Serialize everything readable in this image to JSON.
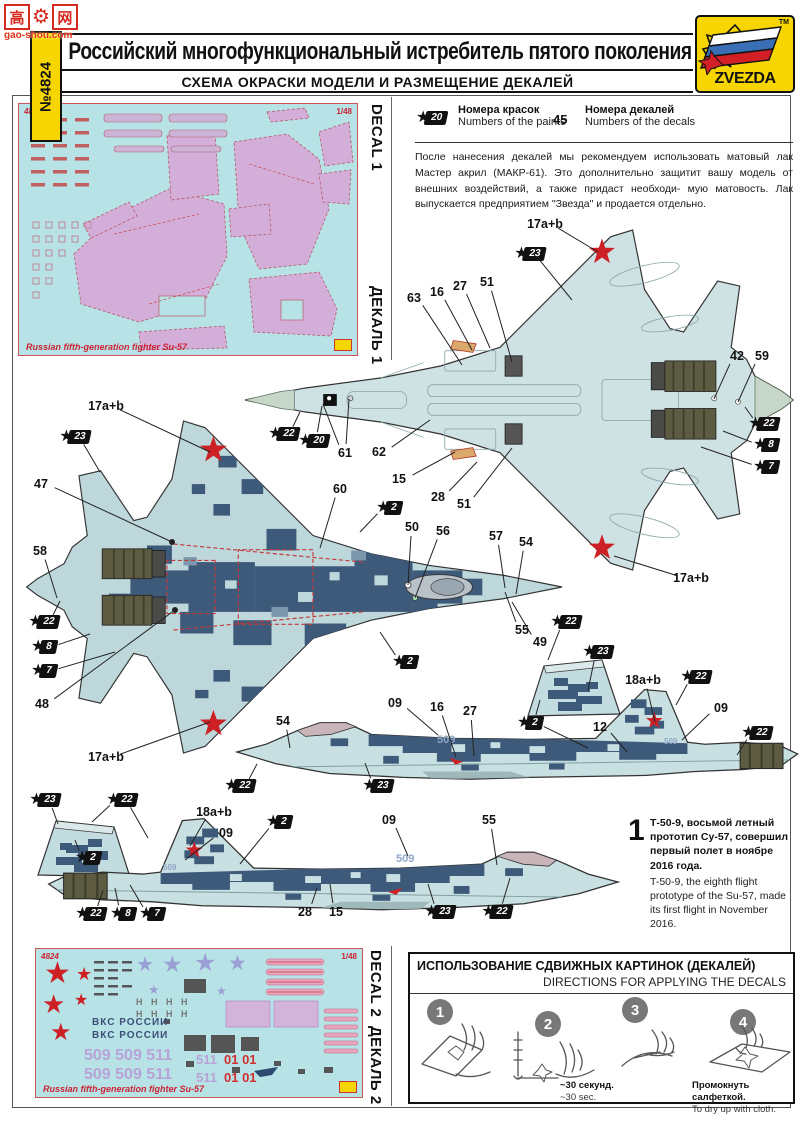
{
  "watermark": {
    "char1": "高",
    "char2": "网",
    "domain": "gao-shou.com"
  },
  "header": {
    "kit_number": "№4824",
    "title": "Российский многофункциональный истребитель пятого поколения Су-57",
    "subtitle": "СХЕМА ОКРАСКИ МОДЕЛИ И РАЗМЕЩЕНИЕ ДЕКАЛЕЙ",
    "brand": "ZVEZDA",
    "brand_tm": "TM"
  },
  "legend": {
    "paint_badge": "20",
    "paint_label_ru": "Номера красок",
    "paint_label_en": "Numbers of the paints",
    "decal_number": "45",
    "decal_label_ru": "Номера декалей",
    "decal_label_en": "Numbers of the decals",
    "note": "После нанесения декалей мы рекомендуем использовать матовый лак Мастер акрил (МАКР-61). Это дополнительно защитит вашу модель от внешних воздействий, а также придаст необходи- мую матовость. Лак выпускается предприятием \"Звезда\" и продается отдельно."
  },
  "decal_sheet_1": {
    "code": "4824",
    "scale": "1/48",
    "caption": "Russian fifth-generation fighter Su-57",
    "side_label_en": "DECAL 1",
    "side_label_ru": "ДЕКАЛЬ 1"
  },
  "decal_sheet_2": {
    "code": "4824",
    "scale": "1/48",
    "caption": "Russian fifth-generation fighter Su-57",
    "side_label_en": "DECAL 2",
    "side_label_ru": "ДЕКАЛЬ 2",
    "vks_text": "ВКС РОССИИ",
    "numbers_row": "509 509 511",
    "numbers_511": "511",
    "numbers_01": "01 01"
  },
  "aircraft": {
    "tail_number": "509"
  },
  "note_block": {
    "index": "1",
    "ru": "Т-50-9, восьмой летный прототип Су-57, совершил первый полет в ноябре 2016 года.",
    "en": "T-50-9, the eighth flight prototype of the Su-57, made its first flight in November 2016."
  },
  "directions": {
    "title_ru": "ИСПОЛЬЗОВАНИЕ СДВИЖНЫХ КАРТИНОК (ДЕКАЛЕЙ)",
    "title_en": "DIRECTIONS  FOR APPLYING THE DECALS",
    "step1": "1",
    "step2": "2",
    "step3": "3",
    "step4": "4",
    "cap2_ru": "~30 секунд.",
    "cap2_en": "~30 sec.",
    "cap4_ru": "Промокнуть салфеткой.",
    "cap4_en": "To dry up with cloth."
  },
  "colors": {
    "brand_yellow": "#f6d500",
    "decal_sheet_bg": "#b7e2e6",
    "decal_pink": "#d2aed8",
    "airframe_light": "#cfe2e3",
    "camo_dark": "#3e5a7a",
    "star_red": "#cc2025"
  },
  "callouts": [
    {
      "t": "plain",
      "v": "17a+b",
      "x": 545,
      "y": 224,
      "l": [
        [
          598,
          252
        ]
      ]
    },
    {
      "t": "badge",
      "v": "23",
      "x": 530,
      "y": 254,
      "l": [
        [
          572,
          300
        ]
      ]
    },
    {
      "t": "plain",
      "v": "63",
      "x": 414,
      "y": 298,
      "l": [
        [
          462,
          365
        ]
      ]
    },
    {
      "t": "plain",
      "v": "16",
      "x": 437,
      "y": 292,
      "l": [
        [
          472,
          350
        ]
      ]
    },
    {
      "t": "plain",
      "v": "27",
      "x": 460,
      "y": 286,
      "l": [
        [
          490,
          348
        ]
      ]
    },
    {
      "t": "plain",
      "v": "51",
      "x": 487,
      "y": 282,
      "l": [
        [
          512,
          362
        ]
      ]
    },
    {
      "t": "plain",
      "v": "42",
      "x": 737,
      "y": 356,
      "l": [
        [
          714,
          399
        ]
      ]
    },
    {
      "t": "plain",
      "v": "59",
      "x": 762,
      "y": 356,
      "l": [
        [
          738,
          402
        ]
      ]
    },
    {
      "t": "badge",
      "v": "22",
      "x": 764,
      "y": 424,
      "l": [
        [
          745,
          407
        ]
      ]
    },
    {
      "t": "badge",
      "v": "8",
      "x": 766,
      "y": 445,
      "l": [
        [
          723,
          431
        ]
      ]
    },
    {
      "t": "badge",
      "v": "7",
      "x": 766,
      "y": 467,
      "l": [
        [
          701,
          447
        ]
      ]
    },
    {
      "t": "badge",
      "v": "22",
      "x": 284,
      "y": 434,
      "l": [
        [
          300,
          412
        ]
      ]
    },
    {
      "t": "badge",
      "v": "20",
      "x": 314,
      "y": 441,
      "l": [
        [
          322,
          406
        ]
      ]
    },
    {
      "t": "plain",
      "v": "61",
      "x": 345,
      "y": 453,
      "l": [
        [
          323,
          404
        ],
        [
          349,
          399
        ]
      ]
    },
    {
      "t": "plain",
      "v": "62",
      "x": 379,
      "y": 452,
      "l": [
        [
          430,
          420
        ]
      ]
    },
    {
      "t": "plain",
      "v": "15",
      "x": 399,
      "y": 479,
      "l": [
        [
          455,
          452
        ]
      ]
    },
    {
      "t": "plain",
      "v": "28",
      "x": 438,
      "y": 497,
      "l": [
        [
          477,
          462
        ]
      ]
    },
    {
      "t": "plain",
      "v": "51",
      "x": 464,
      "y": 504,
      "l": [
        [
          512,
          448
        ]
      ]
    },
    {
      "t": "plain",
      "v": "17a+b",
      "x": 691,
      "y": 578,
      "l": [
        [
          614,
          556
        ]
      ]
    },
    {
      "t": "plain",
      "v": "17a+b",
      "x": 106,
      "y": 406,
      "l": [
        [
          210,
          452
        ]
      ]
    },
    {
      "t": "badge",
      "v": "23",
      "x": 75,
      "y": 437,
      "l": [
        [
          100,
          472
        ]
      ]
    },
    {
      "t": "plain",
      "v": "47",
      "x": 41,
      "y": 484,
      "l": [
        [
          172,
          542
        ]
      ]
    },
    {
      "t": "plain",
      "v": "58",
      "x": 40,
      "y": 551,
      "l": [
        [
          57,
          598
        ]
      ]
    },
    {
      "t": "badge",
      "v": "22",
      "x": 44,
      "y": 622,
      "l": [
        [
          60,
          601
        ]
      ]
    },
    {
      "t": "badge",
      "v": "8",
      "x": 44,
      "y": 647,
      "l": [
        [
          90,
          634
        ]
      ]
    },
    {
      "t": "badge",
      "v": "7",
      "x": 44,
      "y": 671,
      "l": [
        [
          115,
          652
        ]
      ]
    },
    {
      "t": "plain",
      "v": "48",
      "x": 42,
      "y": 704,
      "l": [
        [
          175,
          610
        ]
      ]
    },
    {
      "t": "plain",
      "v": "60",
      "x": 340,
      "y": 489,
      "l": [
        [
          320,
          548
        ]
      ]
    },
    {
      "t": "badge",
      "v": "2",
      "x": 389,
      "y": 508,
      "l": [
        [
          360,
          532
        ]
      ]
    },
    {
      "t": "plain",
      "v": "50",
      "x": 412,
      "y": 527,
      "l": [
        [
          408,
          585
        ]
      ]
    },
    {
      "t": "plain",
      "v": "56",
      "x": 443,
      "y": 531,
      "l": [
        [
          415,
          598
        ]
      ]
    },
    {
      "t": "plain",
      "v": "57",
      "x": 496,
      "y": 536,
      "l": [
        [
          505,
          588
        ]
      ]
    },
    {
      "t": "plain",
      "v": "54",
      "x": 526,
      "y": 542,
      "l": [
        [
          516,
          594
        ]
      ]
    },
    {
      "t": "plain",
      "v": "49",
      "x": 540,
      "y": 642,
      "l": [
        [
          512,
          602
        ]
      ]
    },
    {
      "t": "plain",
      "v": "55",
      "x": 522,
      "y": 630,
      "l": [
        [
          505,
          592
        ]
      ]
    },
    {
      "t": "badge",
      "v": "2",
      "x": 405,
      "y": 662,
      "l": [
        [
          380,
          632
        ]
      ]
    },
    {
      "t": "plain",
      "v": "17a+b",
      "x": 106,
      "y": 757,
      "l": [
        [
          210,
          722
        ]
      ]
    },
    {
      "t": "badge",
      "v": "22",
      "x": 566,
      "y": 622,
      "l": [
        [
          548,
          660
        ]
      ]
    },
    {
      "t": "badge",
      "v": "23",
      "x": 598,
      "y": 652,
      "l": [
        [
          588,
          690
        ]
      ]
    },
    {
      "t": "badge",
      "v": "2",
      "x": 530,
      "y": 723,
      "l": [
        [
          540,
          700
        ],
        [
          588,
          748
        ]
      ]
    },
    {
      "t": "plain",
      "v": "54",
      "x": 283,
      "y": 721,
      "l": [
        [
          290,
          748
        ]
      ]
    },
    {
      "t": "plain",
      "v": "09",
      "x": 395,
      "y": 703,
      "l": [
        [
          438,
          735
        ]
      ]
    },
    {
      "t": "plain",
      "v": "16",
      "x": 437,
      "y": 707,
      "l": [
        [
          456,
          757
        ]
      ]
    },
    {
      "t": "plain",
      "v": "27",
      "x": 470,
      "y": 711,
      "l": [
        [
          474,
          756
        ]
      ]
    },
    {
      "t": "plain",
      "v": "12",
      "x": 600,
      "y": 727,
      "l": [
        [
          627,
          752
        ]
      ]
    },
    {
      "t": "plain",
      "v": "18a+b",
      "x": 643,
      "y": 680,
      "l": [
        [
          655,
          722
        ]
      ]
    },
    {
      "t": "badge",
      "v": "22",
      "x": 696,
      "y": 677,
      "l": [
        [
          676,
          705
        ]
      ]
    },
    {
      "t": "plain",
      "v": "09",
      "x": 721,
      "y": 708,
      "l": [
        [
          682,
          740
        ]
      ]
    },
    {
      "t": "badge",
      "v": "22",
      "x": 757,
      "y": 733,
      "l": [
        [
          737,
          755
        ]
      ]
    },
    {
      "t": "badge",
      "v": "22",
      "x": 240,
      "y": 786,
      "l": [
        [
          257,
          764
        ]
      ]
    },
    {
      "t": "badge",
      "v": "23",
      "x": 378,
      "y": 786,
      "l": [
        [
          365,
          763
        ]
      ]
    },
    {
      "t": "badge",
      "v": "23",
      "x": 45,
      "y": 800,
      "l": [
        [
          58,
          824
        ]
      ]
    },
    {
      "t": "badge",
      "v": "22",
      "x": 122,
      "y": 800,
      "l": [
        [
          92,
          822
        ],
        [
          148,
          838
        ]
      ]
    },
    {
      "t": "badge",
      "v": "2",
      "x": 88,
      "y": 858,
      "l": [
        [
          75,
          840
        ]
      ]
    },
    {
      "t": "plain",
      "v": "18a+b",
      "x": 214,
      "y": 812,
      "l": [
        [
          190,
          846
        ]
      ]
    },
    {
      "t": "plain",
      "v": "09",
      "x": 226,
      "y": 833,
      "l": [
        [
          185,
          860
        ]
      ]
    },
    {
      "t": "badge",
      "v": "2",
      "x": 279,
      "y": 822,
      "l": [
        [
          240,
          864
        ]
      ]
    },
    {
      "t": "plain",
      "v": "09",
      "x": 389,
      "y": 820,
      "l": [
        [
          408,
          856
        ]
      ]
    },
    {
      "t": "plain",
      "v": "55",
      "x": 489,
      "y": 820,
      "l": [
        [
          497,
          865
        ]
      ]
    },
    {
      "t": "badge",
      "v": "22",
      "x": 91,
      "y": 914,
      "l": [
        [
          103,
          890
        ]
      ]
    },
    {
      "t": "badge",
      "v": "8",
      "x": 123,
      "y": 914,
      "l": [
        [
          115,
          888
        ]
      ]
    },
    {
      "t": "badge",
      "v": "7",
      "x": 152,
      "y": 914,
      "l": [
        [
          130,
          885
        ]
      ]
    },
    {
      "t": "plain",
      "v": "28",
      "x": 305,
      "y": 912,
      "l": [
        [
          317,
          888
        ]
      ]
    },
    {
      "t": "plain",
      "v": "15",
      "x": 336,
      "y": 912,
      "l": [
        [
          330,
          884
        ]
      ]
    },
    {
      "t": "badge",
      "v": "23",
      "x": 440,
      "y": 912,
      "l": [
        [
          428,
          884
        ]
      ]
    },
    {
      "t": "badge",
      "v": "22",
      "x": 497,
      "y": 912,
      "l": [
        [
          510,
          878
        ]
      ]
    }
  ]
}
